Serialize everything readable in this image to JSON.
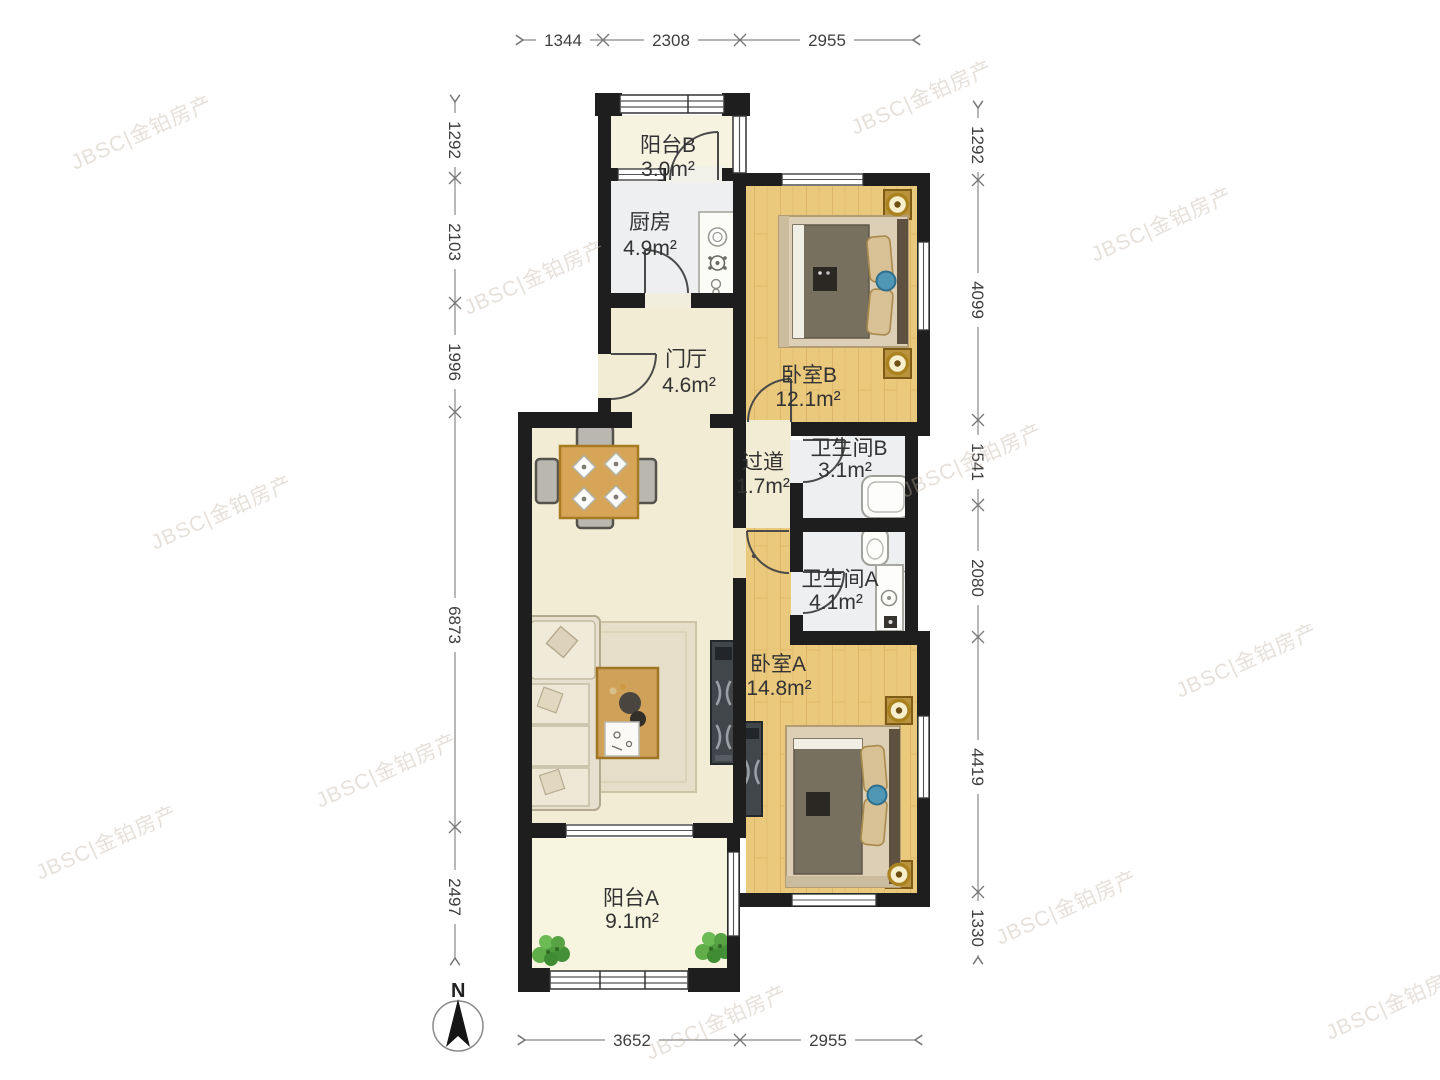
{
  "plan_title": "两居室户型平面图",
  "watermark": {
    "text": "JBSC|金铂房产"
  },
  "compass": {
    "north_label": "N"
  },
  "rooms": {
    "balcony_b": {
      "name": "阳台B",
      "area": "3.0m²"
    },
    "kitchen": {
      "name": "厨房",
      "area": "4.9m²"
    },
    "bedroom_b": {
      "name": "卧室B",
      "area": "12.1m²"
    },
    "hall": {
      "name": "门厅",
      "area": "4.6m²"
    },
    "corridor": {
      "name": "过道",
      "area": "1.7m²"
    },
    "bathroom_b": {
      "name": "卫生间B",
      "area": "3.1m²"
    },
    "bathroom_a": {
      "name": "卫生间A",
      "area": "4.1m²"
    },
    "bedroom_a": {
      "name": "卧室A",
      "area": "14.8m²"
    },
    "balcony_a": {
      "name": "阳台A",
      "area": "9.1m²"
    }
  },
  "dimensions": {
    "top": [
      "1344",
      "2308",
      "2955"
    ],
    "bottom": [
      "3652",
      "2955"
    ],
    "left": [
      "1292",
      "2103",
      "1996",
      "6873",
      "2497"
    ],
    "right": [
      "1292",
      "4099",
      "1541",
      "2080",
      "4419",
      "1330"
    ]
  },
  "colors": {
    "wall": "#1e1e1e",
    "wood_floor": "#eac87c",
    "cream_floor": "#f3ecd4",
    "tile_floor": "#edeff0",
    "balcony_floor": "#f6f3e1",
    "gold_accent": "#a9821f",
    "plant_green": "#54a142",
    "blue_accent": "#4f97b4"
  }
}
